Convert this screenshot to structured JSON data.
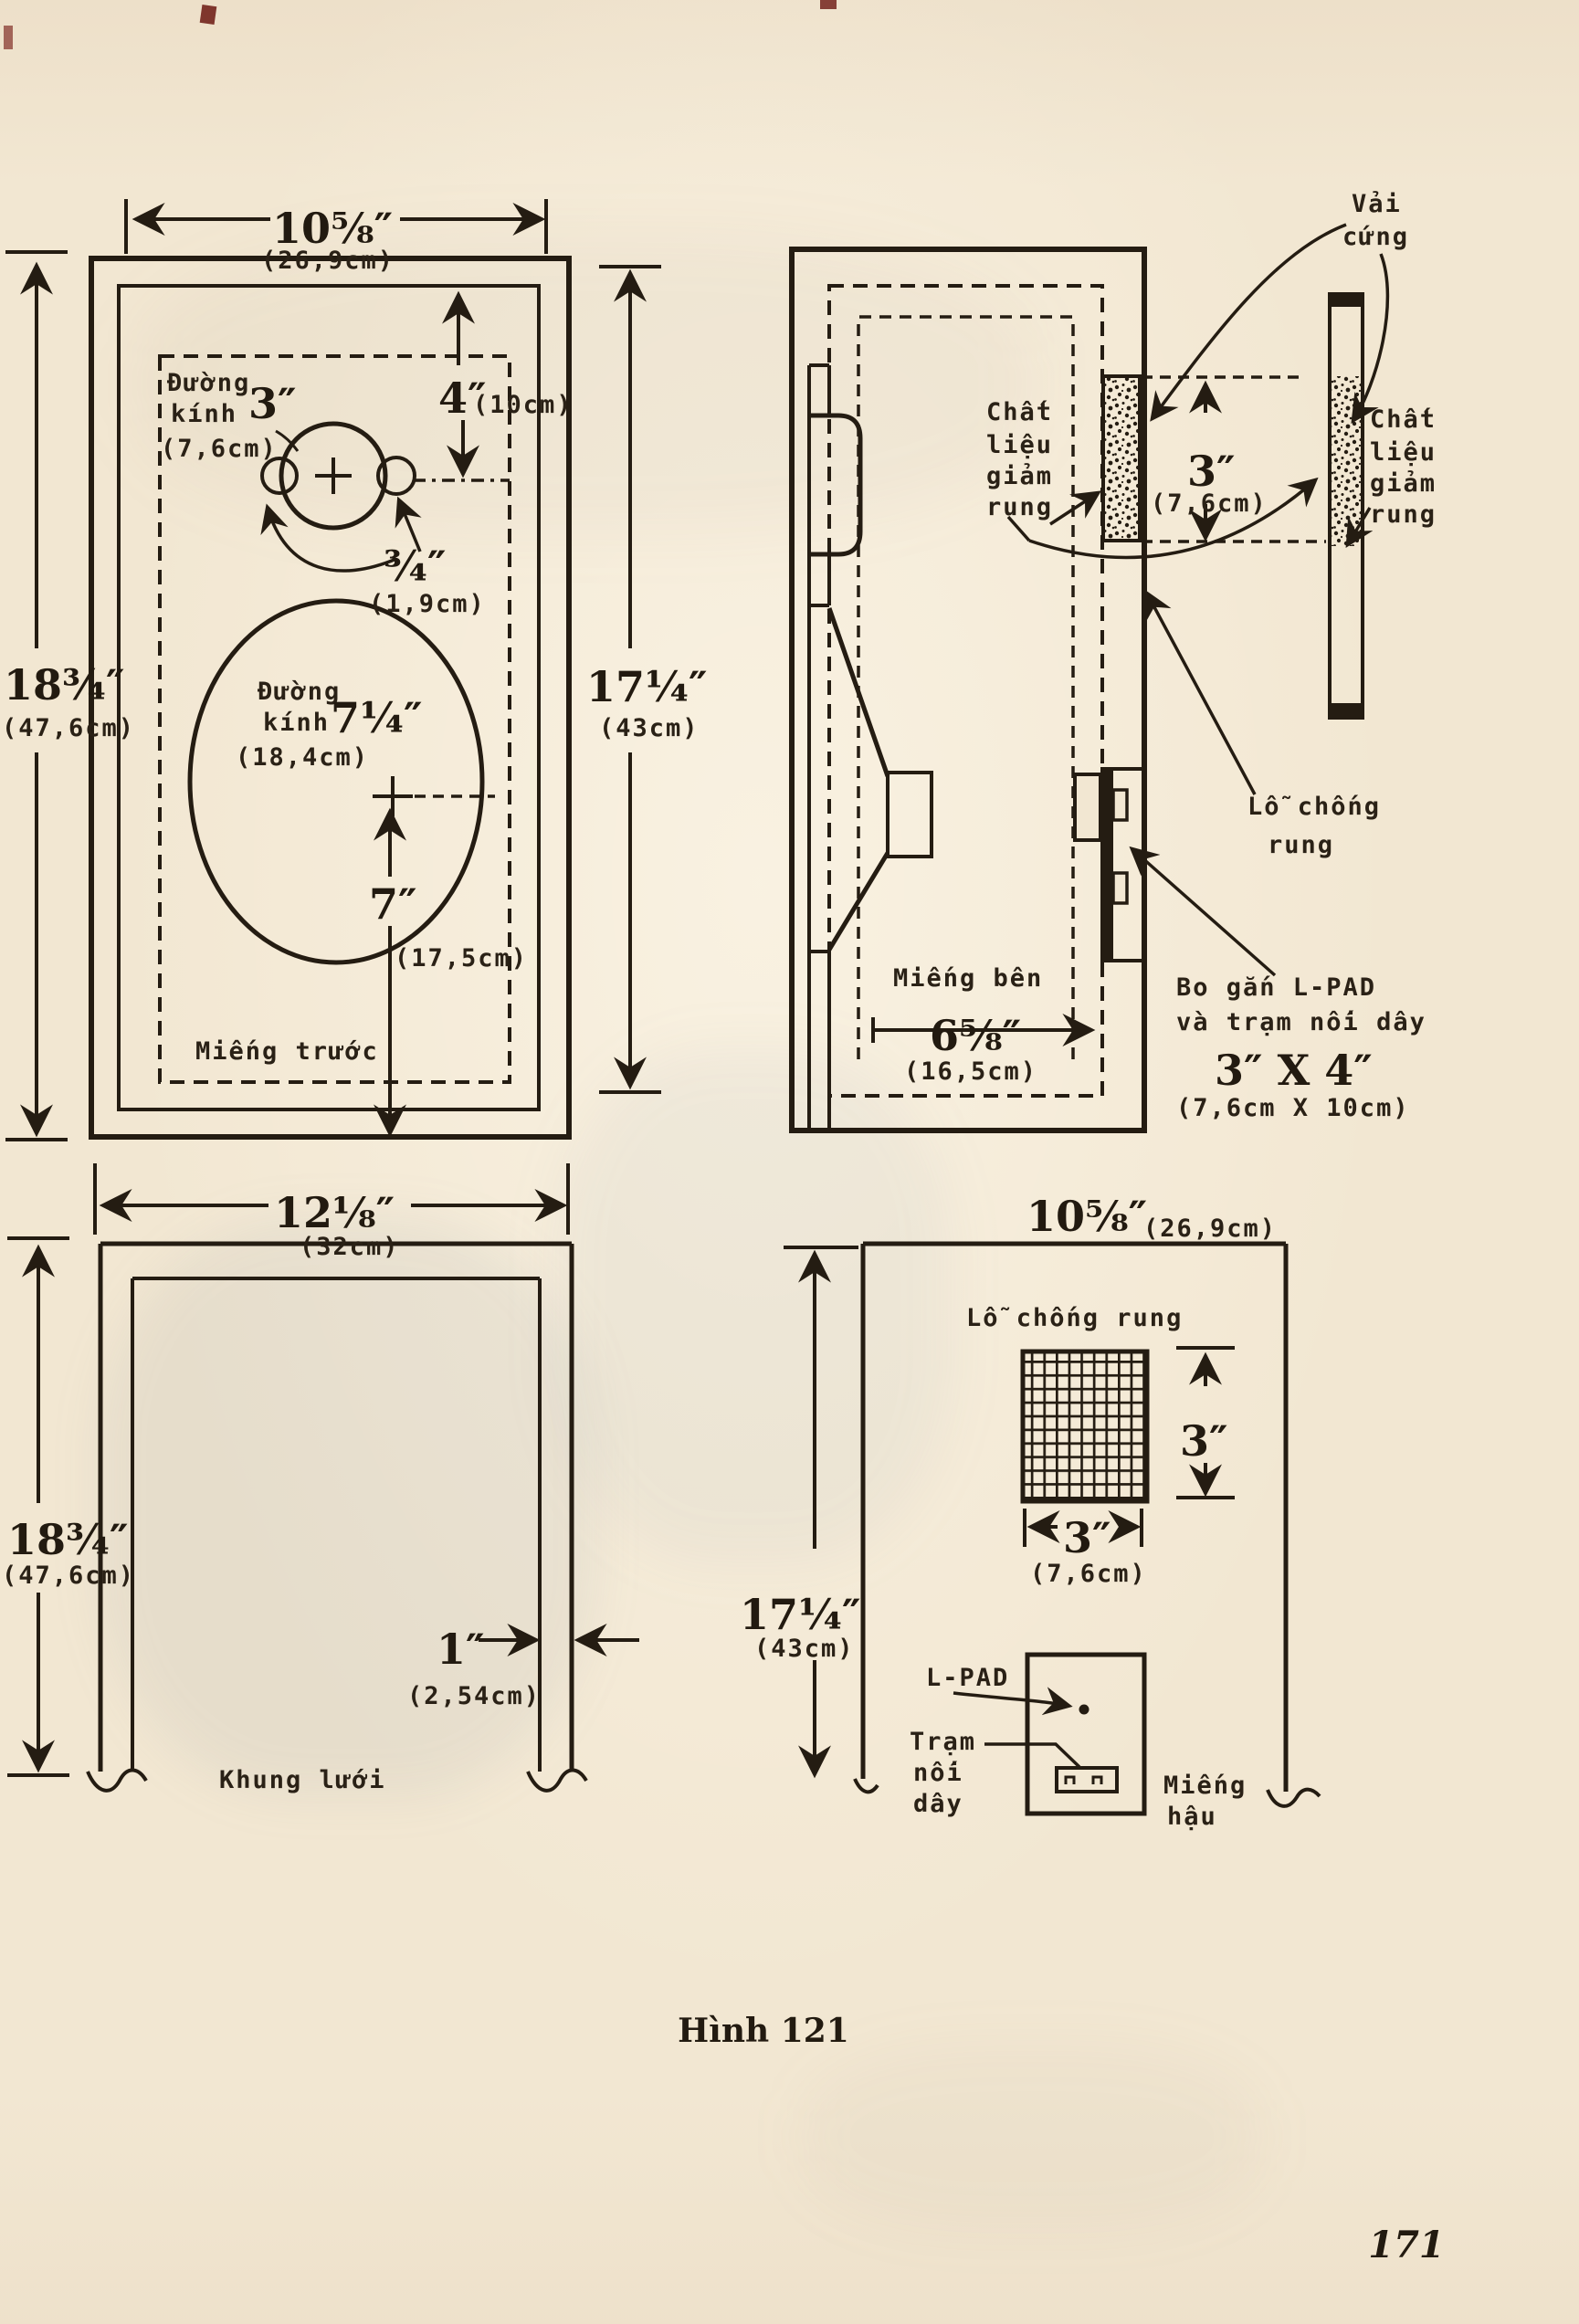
{
  "page": {
    "caption": "Hình 121",
    "page_number": "171"
  },
  "front_panel": {
    "name": "Miếng trước",
    "width_in": "10⅝″",
    "width_cm": "(26,9cm)",
    "height_in": "18¾″",
    "height_cm": "(47,6cm)",
    "cutout_height_in": "17¼″",
    "cutout_height_cm": "(43cm)",
    "tweeter_dia_label_1": "Đường",
    "tweeter_dia_label_2": "kính",
    "tweeter_dia_in": "3″",
    "tweeter_dia_cm": "(7,6cm)",
    "tweeter_top_in": "4″",
    "tweeter_top_cm": "(10cm)",
    "tweeter_offset_in": "¾″",
    "tweeter_offset_cm": "(1,9cm)",
    "woofer_dia_label_1": "Đường",
    "woofer_dia_label_2": "kính",
    "woofer_dia_in": "7¼″",
    "woofer_dia_cm": "(18,4cm)",
    "woofer_bottom_in": "7″",
    "woofer_bottom_cm": "(17,5cm)"
  },
  "side_panel": {
    "name": "Miếng bên",
    "depth_in": "6⅝″",
    "depth_cm": "(16,5cm)",
    "damping_1": "Chất",
    "damping_2": "liệu",
    "damping_3": "giảm",
    "damping_4": "rung",
    "hole_1": "Lỗ chống",
    "hole_2": "rung",
    "lpad_note_1": "Bo gắn L-PAD",
    "lpad_note_2": "và trạm nối dây",
    "lpad_note_3": "3″ X 4″",
    "lpad_note_4": "(7,6cm X 10cm)"
  },
  "damping_detail": {
    "cloth_1": "Vải",
    "cloth_2": "cứng",
    "damping_1": "Chất",
    "damping_2": "liệu",
    "damping_3": "giảm",
    "damping_4": "rung",
    "thickness_in": "3″",
    "thickness_cm": "(7,6cm)"
  },
  "grille": {
    "name": "Khung lưới",
    "width_in": "12⅛″",
    "width_cm": "(32cm)",
    "height_in": "18¾″",
    "height_cm": "(47,6cm)",
    "bar_in": "1″",
    "bar_cm": "(2,54cm)"
  },
  "back_panel": {
    "name_1": "Miếng",
    "name_2": "hậu",
    "width_in": "10⅝″",
    "width_cm": "(26,9cm)",
    "height_in": "17¼″",
    "height_cm": "(43cm)",
    "hole_label": "Lỗ chống rung",
    "hole_height_in": "3″",
    "hole_width_in": "3″",
    "hole_width_cm": "(7,6cm)",
    "lpad_label": "L-PAD",
    "terminal_1": "Trạm",
    "terminal_2": "nối",
    "terminal_3": "dây"
  }
}
